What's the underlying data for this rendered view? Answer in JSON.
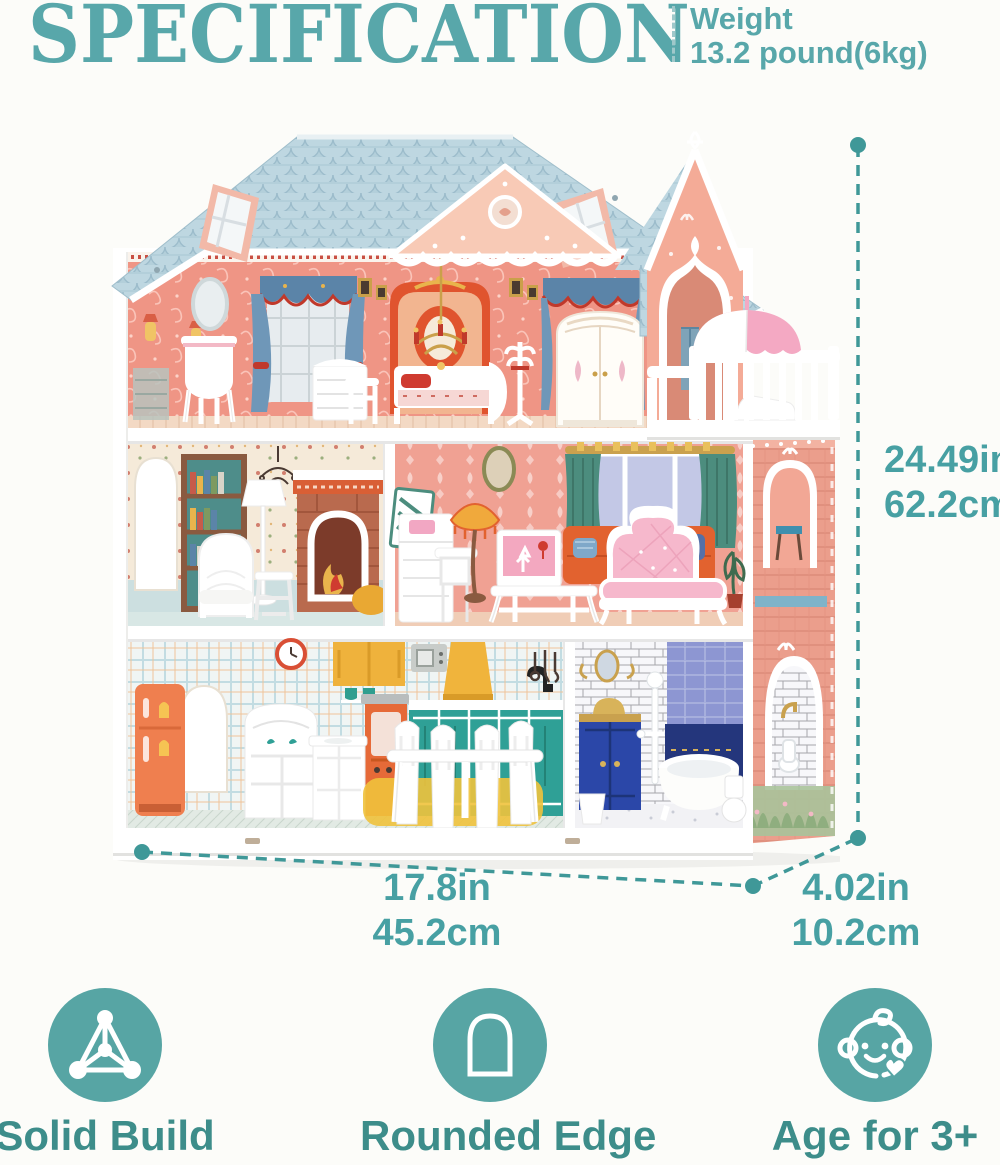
{
  "page": {
    "background_color": "#fcfcf9",
    "accent_teal": "#58a7aa",
    "accent_teal_dark": "#3d8d8a",
    "dimension_line_color": "#3f9898"
  },
  "header": {
    "title": "SPECIFICATION",
    "weight": {
      "label": "Weight",
      "value": "13.2 pound(6kg)"
    }
  },
  "product": {
    "name": "Three-story wooden dollhouse with furniture",
    "photo_alt": "Pastel dollhouse: blue scalloped roof with skylights, pink bedroom floor, library and living room floor, kitchen and bathroom floor, side tower with arch door, balcony and pink umbrella",
    "colors": {
      "roof": "#b3cfda",
      "front_wall": "#ef9585",
      "gable": "#f8cab6",
      "tower_wall": "#f4ab97",
      "side_wall": "#eb9e8c",
      "trim": "#ffffff",
      "kitchen_cabinet": "#2fa096",
      "accent_orange": "#e2622f",
      "accent_yellow": "#efb23c",
      "umbrella_pink": "#f4a9c3"
    }
  },
  "dimensions": {
    "height": {
      "inches": "24.49in",
      "centimeters": "62.2cm"
    },
    "width": {
      "inches": "17.8in",
      "centimeters": "45.2cm"
    },
    "depth": {
      "inches": "4.02in",
      "centimeters": "10.2cm"
    }
  },
  "features": [
    {
      "icon": "molecule-triangle-icon",
      "label": "Solid Build"
    },
    {
      "icon": "rounded-arch-icon",
      "label": "Rounded Edge"
    },
    {
      "icon": "baby-face-icon",
      "label": "Age for 3+"
    }
  ]
}
